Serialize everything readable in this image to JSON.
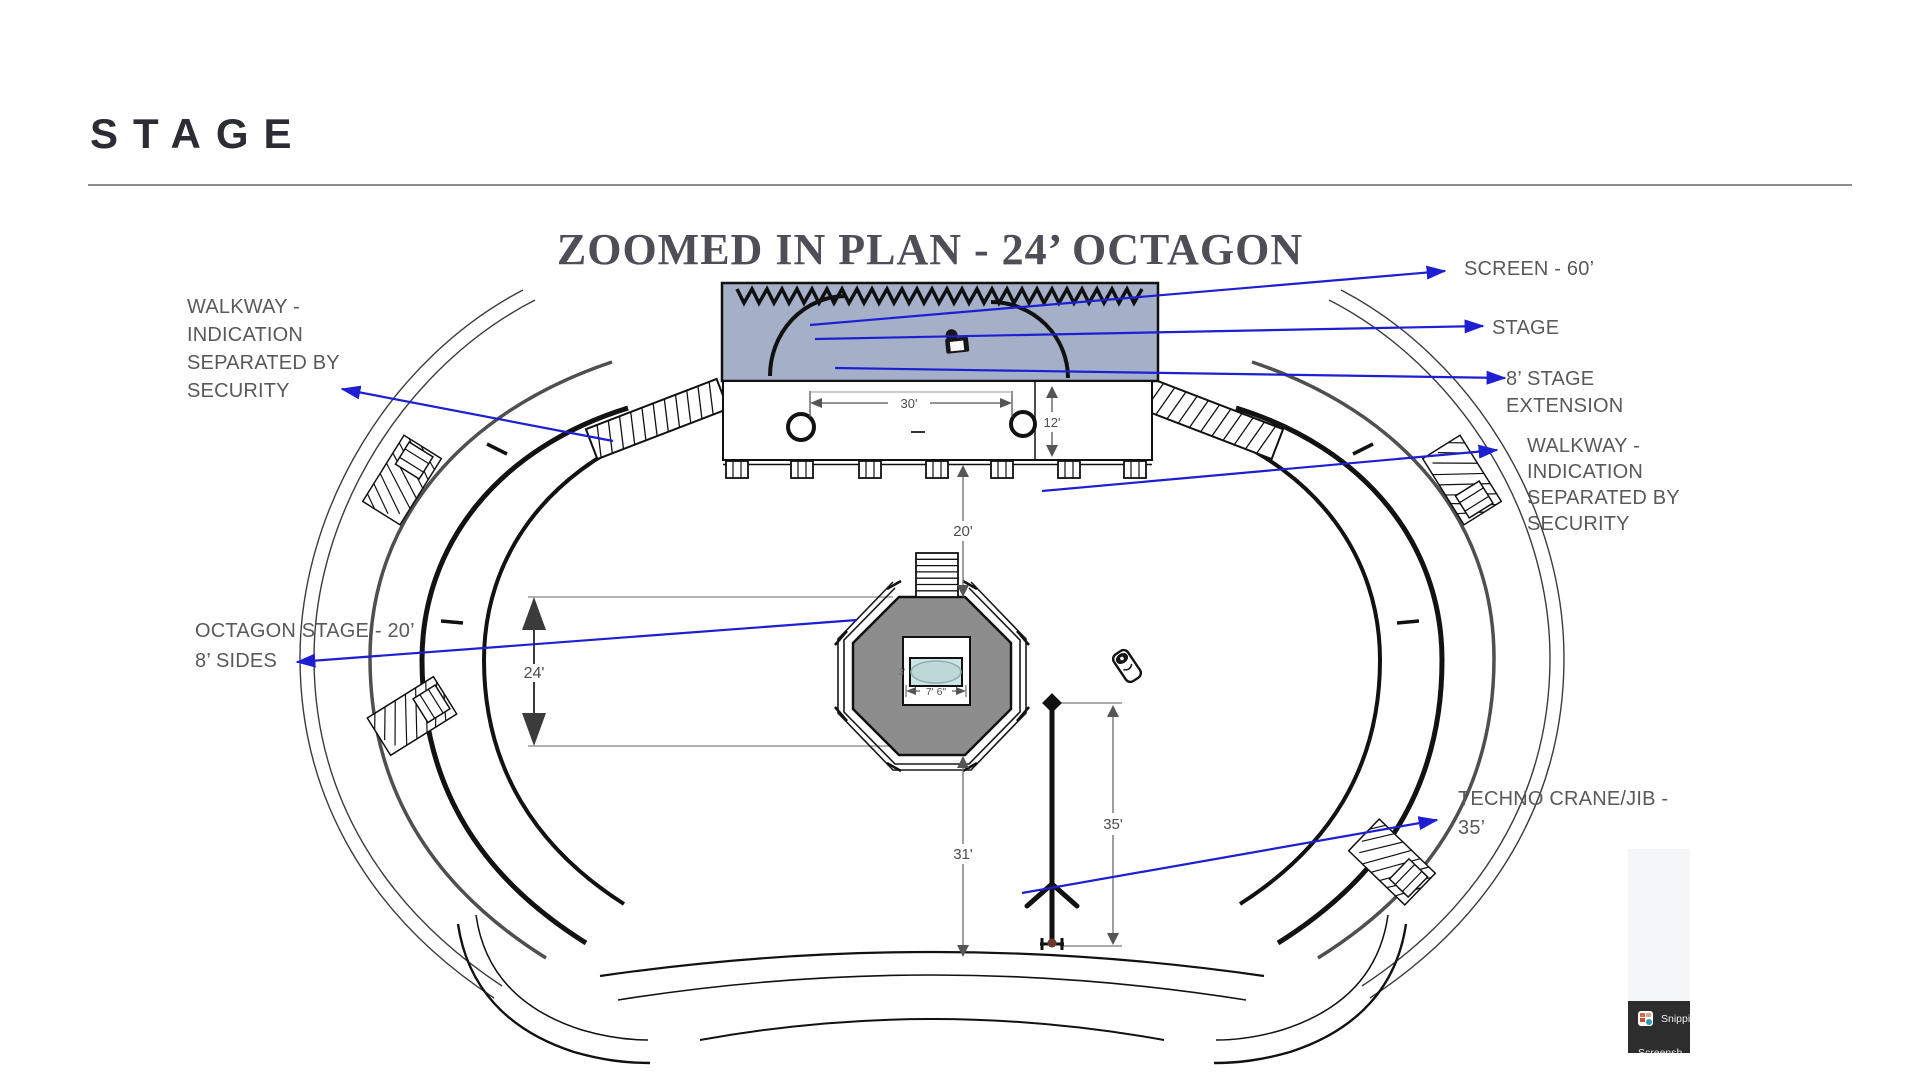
{
  "slide": {
    "heading": "STAGE",
    "plan_title": "ZOOMED IN PLAN - 24’ OCTAGON"
  },
  "annotations": {
    "walkway_left": {
      "lines": [
        "WALKWAY -",
        "INDICATION",
        "SEPARATED BY",
        "SECURITY"
      ]
    },
    "screen": {
      "label": "SCREEN - 60’"
    },
    "stage": {
      "label": "STAGE"
    },
    "stage_extension": {
      "lines": [
        "8’ STAGE",
        "EXTENSION"
      ]
    },
    "walkway_right": {
      "lines": [
        "WALKWAY -",
        "INDICATION",
        "SEPARATED BY",
        "SECURITY"
      ]
    },
    "octagon_stage": {
      "lines": [
        "OCTAGON STAGE - 20’",
        "8’ SIDES"
      ]
    },
    "techno_crane": {
      "lines": [
        "TECHNO CRANE/JIB -",
        "35’"
      ]
    }
  },
  "dimensions": {
    "stage_opening_width": "30'",
    "stage_extension_depth": "12'",
    "stage_to_octagon": "20'",
    "octagon_width": "24'",
    "octagon_to_stage_front": "31'",
    "crane_reach": "35'",
    "piano_width": "7' 6\"",
    "piano_depth": "3'"
  },
  "overlay_window": {
    "icon": "snipping-tool-icon",
    "primary_label": "Snippi",
    "secondary_label": "Screensh"
  },
  "colors": {
    "annotation_blue": "#1e1ed2",
    "stage_fill": "#a4afc8",
    "octagon_fill": "#8d8d8d",
    "piano_fill": "#cfe3e3",
    "label_gray": "#595959"
  }
}
